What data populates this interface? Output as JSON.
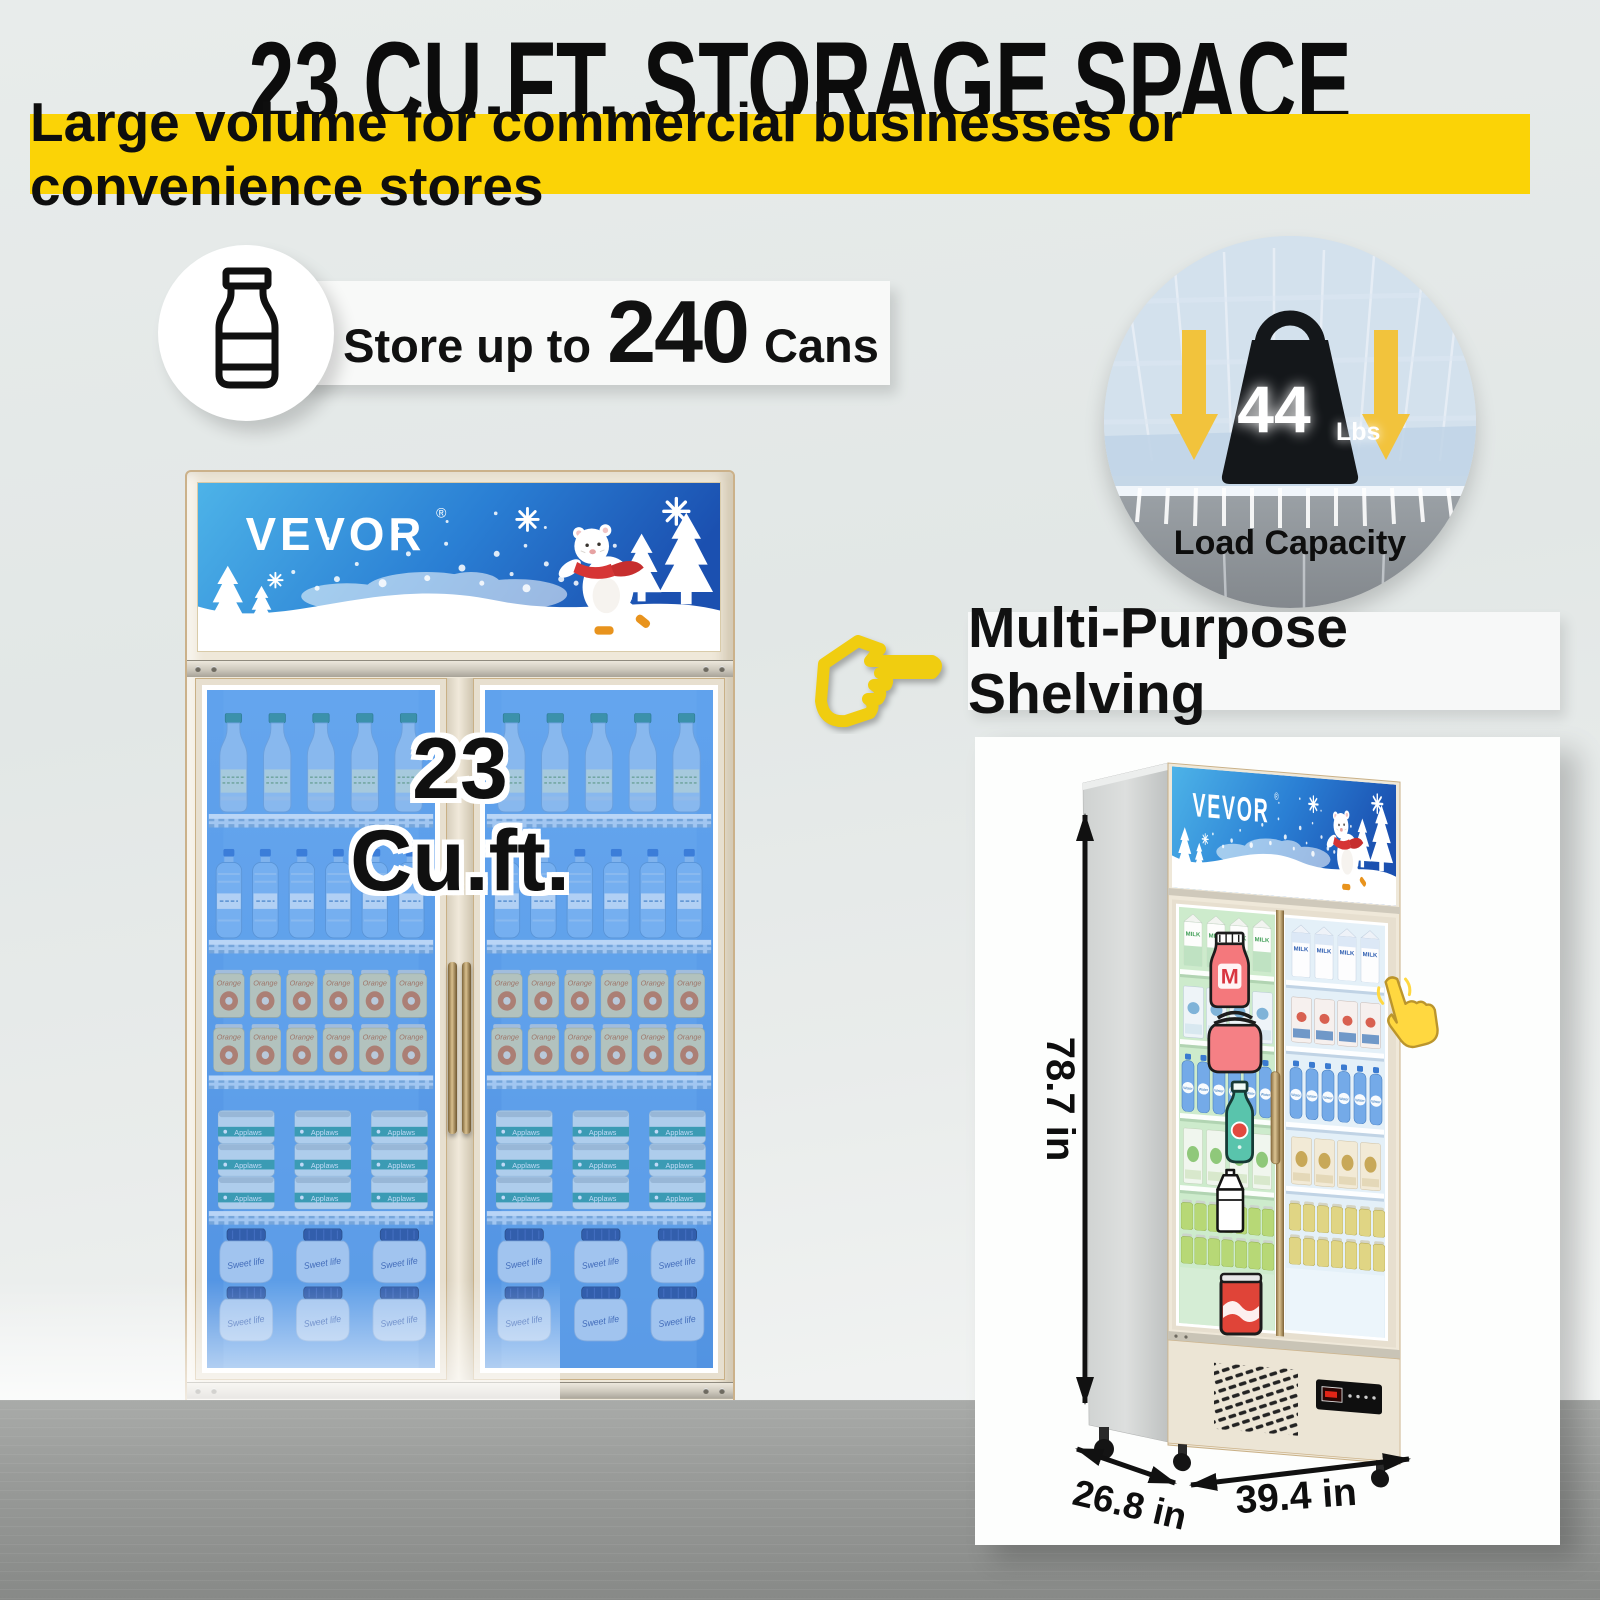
{
  "header": {
    "title": "23 CU.FT. STORAGE SPACE",
    "subtitle": "Large volume for commercial businesses or convenience stores"
  },
  "store_banner": {
    "prefix": "Store up to",
    "number": "240",
    "suffix": "Cans"
  },
  "load_capacity": {
    "value": "44",
    "unit": "Lbs",
    "label": "Load Capacity"
  },
  "shelving": {
    "heading": "Multi-Purpose Shelving"
  },
  "brand": {
    "name": "VEVOR",
    "reg": "®"
  },
  "capacity_overlay": {
    "line1": "23",
    "line2": "Cu.ft."
  },
  "control_panel": {
    "display": "23",
    "degree": "°",
    "button_icons": [
      "○",
      "▲",
      "▼",
      "☼"
    ],
    "buttons": [
      "switch",
      "up",
      "down",
      "lighting"
    ]
  },
  "products": {
    "milk": "MILK",
    "water": "Water",
    "orange": "Orange",
    "applaws": "Applaws",
    "jam": "Sweet life"
  },
  "icons": {
    "milk_letter": "M"
  },
  "dimensions": {
    "height": "78.7 in",
    "depth": "26.8 in",
    "width": "39.4 in"
  },
  "colors": {
    "accent_yellow": "#FBD306",
    "hand_yellow": "#F0CD10",
    "led_red": "#FF2A17",
    "interior_blue": "#5D9FE8",
    "door_green": "#CDEBCC",
    "door_blue": "#E4F0F8"
  }
}
